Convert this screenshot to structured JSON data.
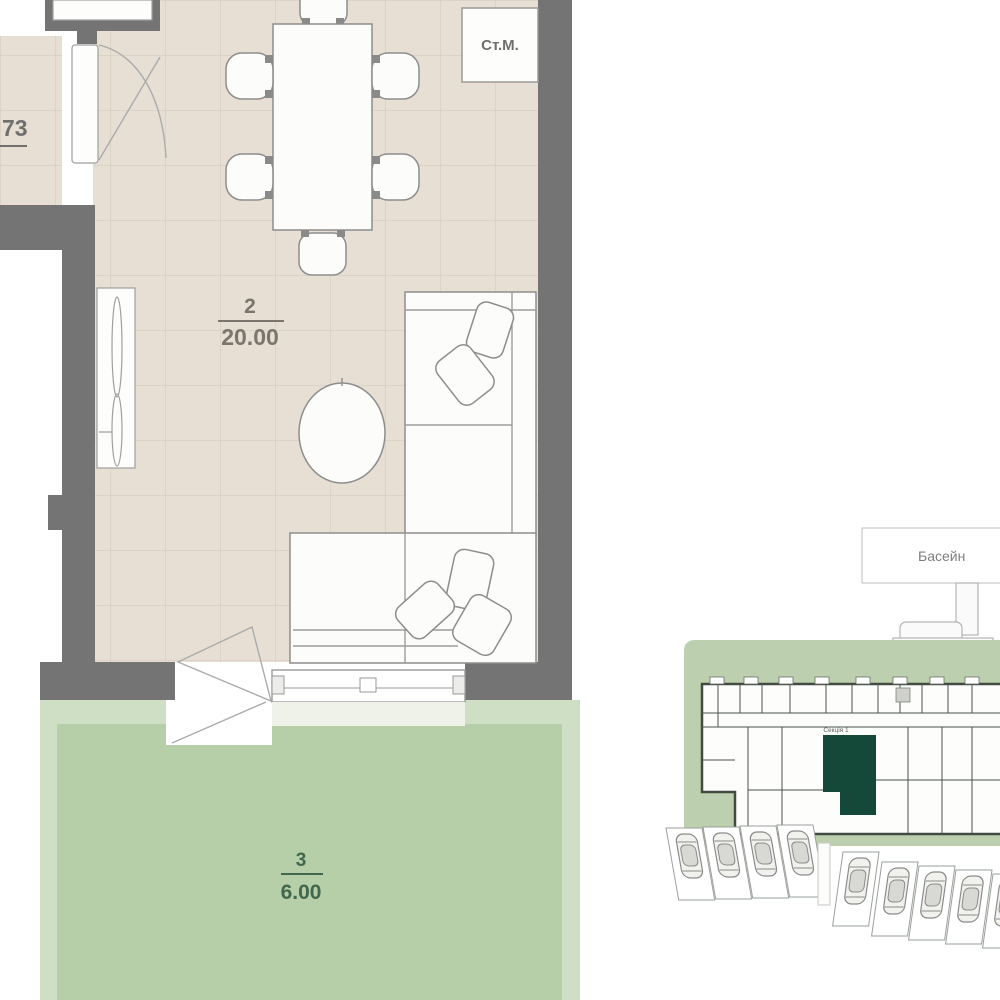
{
  "floor_plan": {
    "living_room": {
      "number": "2",
      "area": "20.00"
    },
    "terrace": {
      "number": "3",
      "area": "6.00"
    },
    "hall_area_label": "73",
    "washer_label": "Ст.М."
  },
  "site_plan": {
    "pool_label": "Басейн",
    "section_label": "Секція 1"
  },
  "colors": {
    "wall": "#747474",
    "floor_tile": "#e7dfd3",
    "tile_grid_line": "#cfc7ba",
    "terrace_inner": "#b6cfa8",
    "terrace_outer": "#cfdfc5",
    "terrace_text": "#41684f",
    "site_green": "#bccfae",
    "highlight_unit": "#14493a",
    "label_gray": "#6f6f6f"
  }
}
